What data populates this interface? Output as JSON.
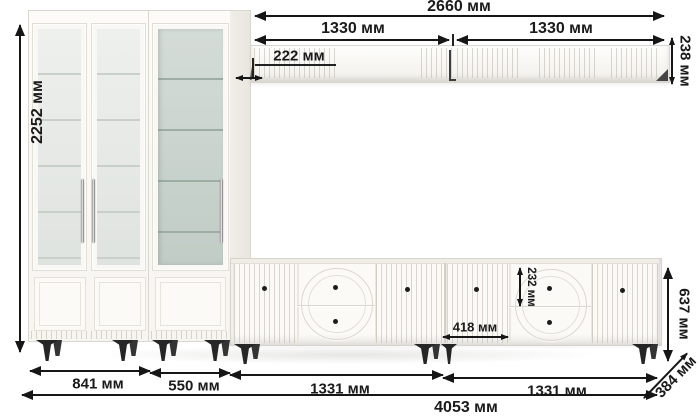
{
  "diagram": {
    "type": "furniture-dimension-diagram",
    "unit": "мм"
  },
  "labels": {
    "shelf_total_width": "2660 мм",
    "shelf_section_left": "1330 мм",
    "shelf_section_right": "1330 мм",
    "shelf_depth": "222 мм",
    "shelf_height": "238 мм",
    "cabinet_height": "2252 мм",
    "tv_stand_height": "637 мм",
    "drawer_height": "232 мм",
    "tv_door_width": "418 мм",
    "glass_cabinet_width": "841 мм",
    "display_cabinet_width": "550 мм",
    "tv_stand_left_width": "1331 мм",
    "tv_stand_right_width": "1331 мм",
    "total_width": "4053 мм",
    "depth": "384 мм"
  },
  "colors": {
    "background": "#ffffff",
    "furniture": "#faf9f5",
    "outline": "#d8d5ce",
    "glass_light": "#e9ece9",
    "glass_tinted": "#c9d4ce",
    "legs": "#262626",
    "dimension_lines": "#161616"
  }
}
